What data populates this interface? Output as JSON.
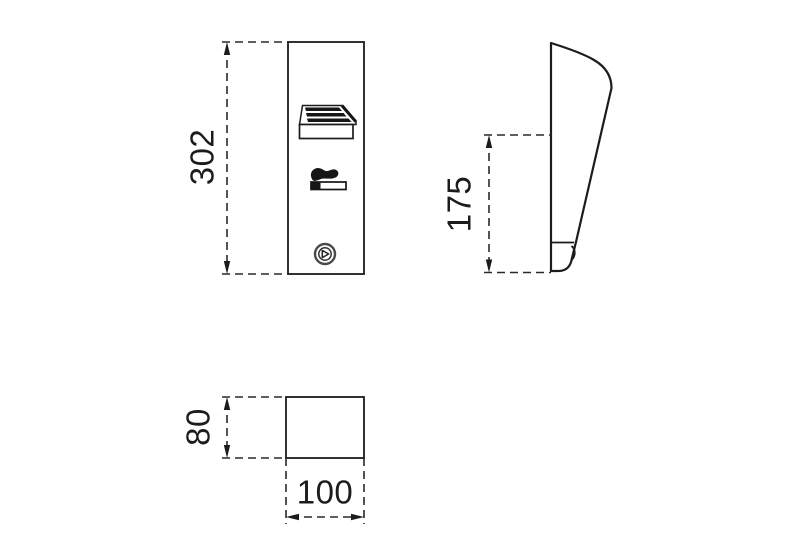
{
  "page": {
    "background": "#ffffff",
    "line_color": "#1c1c1c",
    "description": "technical dimension drawing, three orthographic views"
  },
  "views": {
    "front": {
      "name": "front-view",
      "height_label": "302",
      "icons": [
        {
          "name": "louvre-vent-icon"
        },
        {
          "name": "cigarette-icon"
        },
        {
          "name": "lock-icon"
        }
      ]
    },
    "side": {
      "name": "side-view",
      "height_label": "175"
    },
    "bottom": {
      "name": "bottom-view",
      "depth_label": "80",
      "width_label": "100"
    }
  }
}
